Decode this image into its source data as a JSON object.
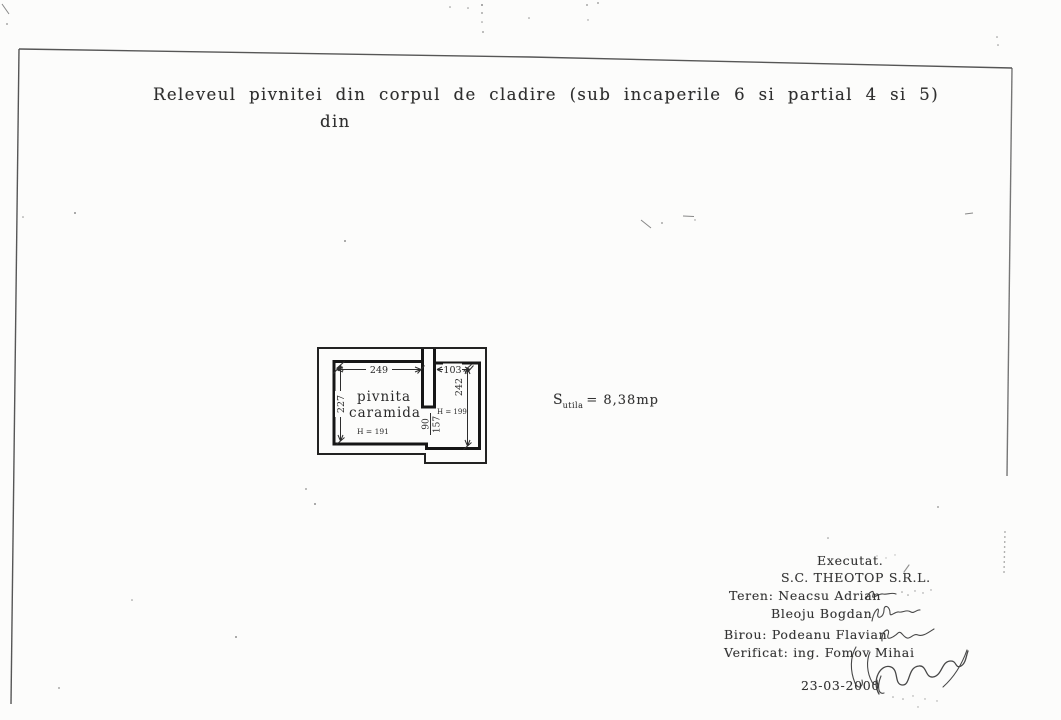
{
  "doc": {
    "title_line1": "Releveul pivnitei din corpul de cladire (sub incaperile 6 si partial 4 si 5)",
    "title_line2": "din"
  },
  "plan": {
    "room_label_line1": "pivnita",
    "room_label_line2": "caramida",
    "room_height": "H = 191",
    "right_section_height": "H = 199",
    "dim_width_main": "249",
    "dim_width_right": "103",
    "dim_depth_left": "227",
    "dim_depth_right": "242",
    "dim_opening_width": "90",
    "dim_opening_height": "157"
  },
  "area": {
    "symbol": "S",
    "subscript": "utila",
    "value": "= 8,38mp"
  },
  "signature_block": {
    "executed": "Executat.",
    "company": "S.C. THEOTOP S.R.L.",
    "surveyor_field": "Teren: Neacsu Adrian",
    "surveyor_field_2": "Bleoju Bogdan",
    "office": "Birou: Podeanu Flavian",
    "verified": "Verificat: ing. Fomov Mihai",
    "date": "23-03-2000"
  },
  "colors": {
    "ink": "#2b2b2b",
    "paper": "#fcfcfb",
    "wall_line": "#171717",
    "border_line": "#3f3f3f"
  }
}
